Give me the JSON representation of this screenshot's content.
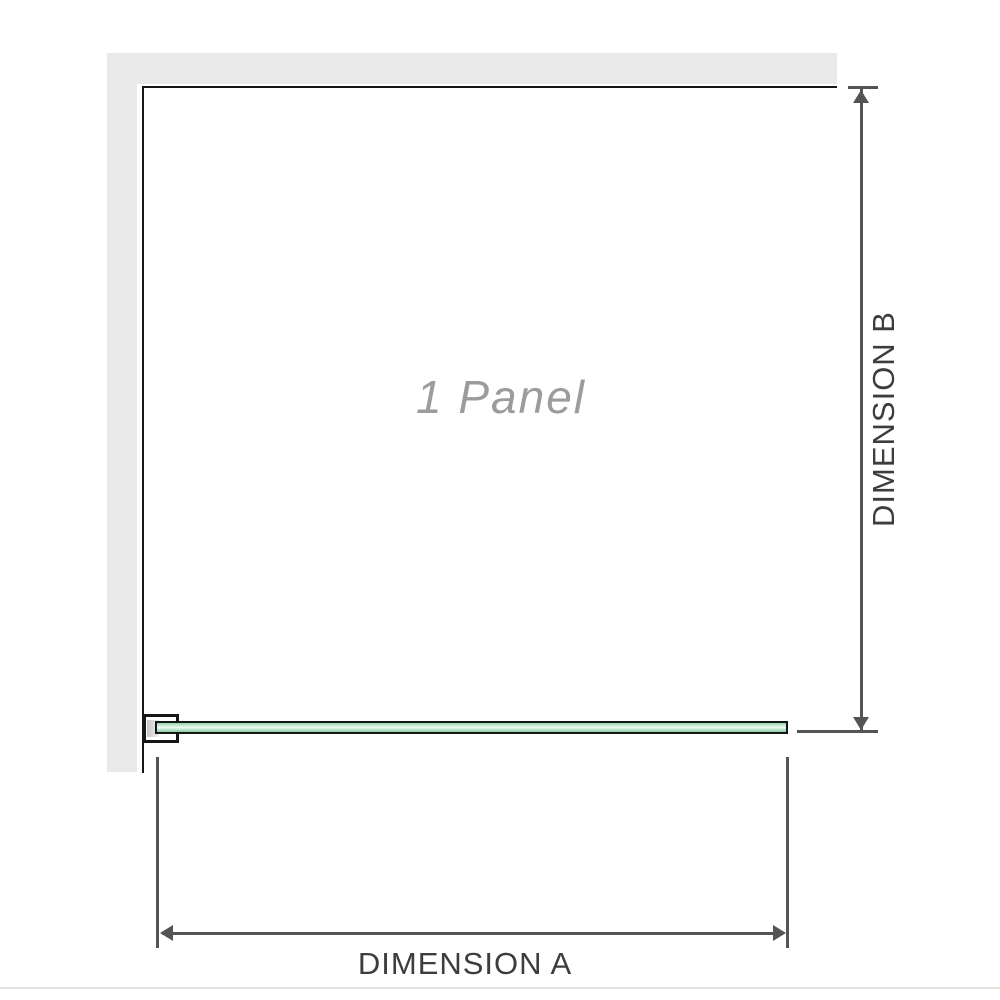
{
  "diagram": {
    "panel": {
      "label": "1 Panel"
    },
    "dimensions": {
      "a": {
        "label": "DIMENSION A",
        "orientation": "horizontal"
      },
      "b": {
        "label": "DIMENSION B",
        "orientation": "vertical"
      }
    }
  },
  "colors": {
    "page_bg": "#ffffff",
    "wall": "#e9e9e9",
    "outline": "#161616",
    "dimension": "#545454",
    "label_text": "#3d3d3d",
    "panel_label_text": "#9c9c9c",
    "glass_top": "#96d4ac",
    "glass_light": "#f2faf5",
    "glass_bottom": "#8bcda2",
    "divider": "#e4e4e2"
  }
}
